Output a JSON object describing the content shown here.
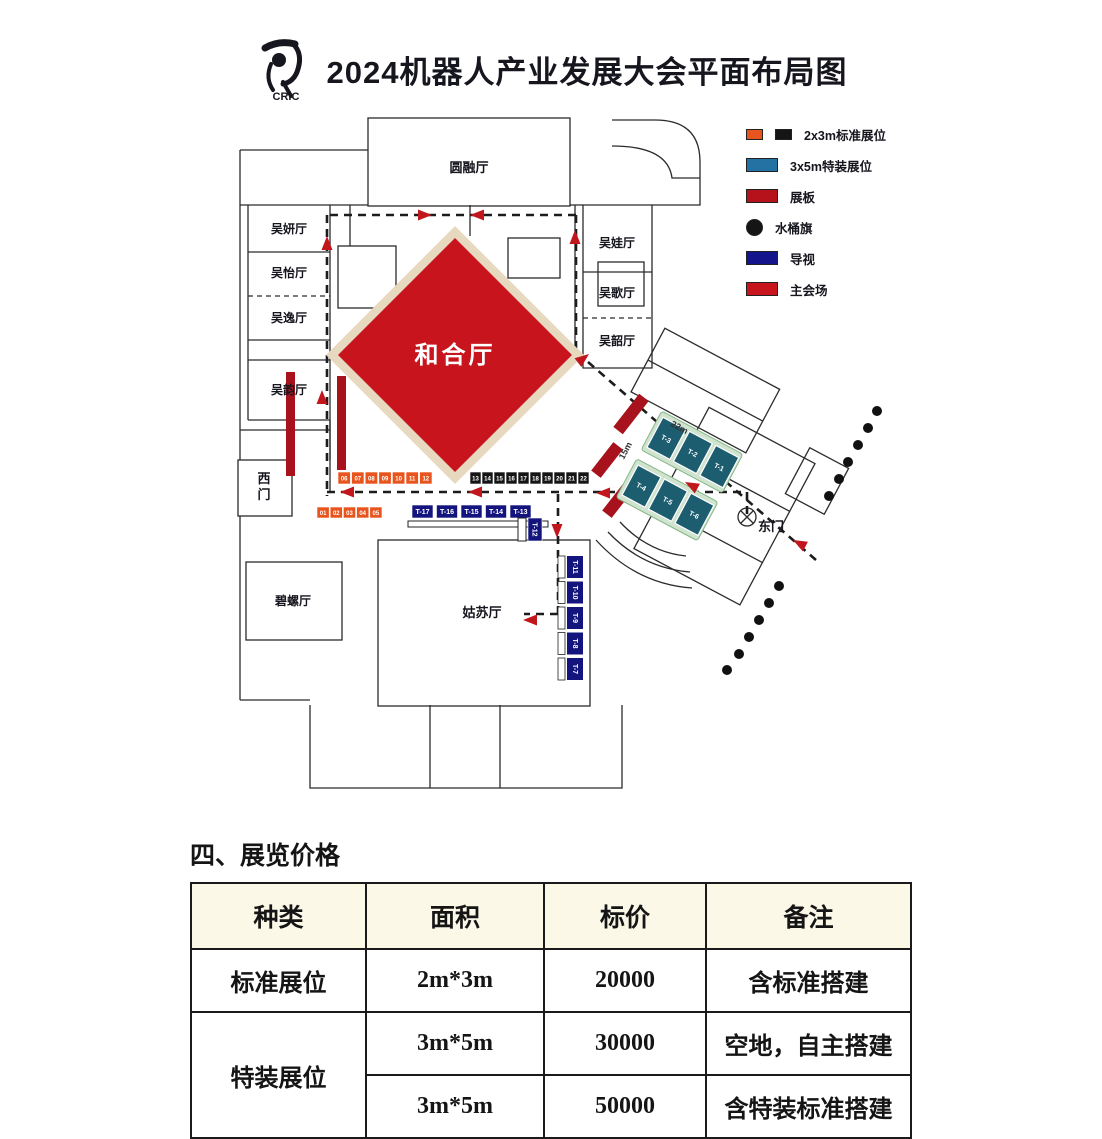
{
  "header": {
    "logo_text": "CRIC",
    "title": "2024机器人产业发展大会平面布局图"
  },
  "legend": {
    "items": [
      {
        "name": "standard-booth",
        "label": "2x3m标准展位",
        "colors": [
          "#e8541d",
          "#151515"
        ],
        "shape": "double-square"
      },
      {
        "name": "special-booth",
        "label": "3x5m特装展位",
        "colors": [
          "#2471a3"
        ],
        "shape": "rect"
      },
      {
        "name": "display-board",
        "label": "展板",
        "colors": [
          "#b5121b"
        ],
        "shape": "rect"
      },
      {
        "name": "water-flag",
        "label": "水桶旗",
        "colors": [
          "#151515"
        ],
        "shape": "circle"
      },
      {
        "name": "signage",
        "label": "导视",
        "colors": [
          "#14148c"
        ],
        "shape": "rect"
      },
      {
        "name": "main-venue",
        "label": "主会场",
        "colors": [
          "#c8141c"
        ],
        "shape": "rect"
      }
    ]
  },
  "plan": {
    "rooms": {
      "yuanrong": "圆融厅",
      "wuyan": "吴妍厅",
      "wuyi": "吴怡厅",
      "wuyi2": "吴逸厅",
      "wuyun": "吴韵厅",
      "wuwa": "吴娃厅",
      "wuge": "吴歌厅",
      "wushao": "吴韶厅",
      "hehe": "和合厅",
      "gusu": "姑苏厅",
      "biluo": "碧螺厅",
      "west_gate": "西门",
      "east_gate": "东门"
    },
    "booths": {
      "orange_row": [
        "06",
        "07",
        "08",
        "09",
        "10",
        "11",
        "12"
      ],
      "black_row": [
        "13",
        "14",
        "15",
        "16",
        "17",
        "18",
        "19",
        "20",
        "21",
        "22"
      ],
      "orange_row2": [
        "01",
        "02",
        "03",
        "04",
        "05"
      ],
      "t_row": [
        "T-17",
        "T-16",
        "T-15",
        "T-14",
        "T-13"
      ],
      "t_single": "T-12",
      "t_column": [
        "T-11",
        "T-10",
        "T-9",
        "T-8",
        "T-7"
      ],
      "cluster_north": [
        "T-3",
        "T-2",
        "T-1"
      ],
      "cluster_south": [
        "T-4",
        "T-5",
        "T-6"
      ]
    },
    "dimensions": {
      "corridor_width": "22m",
      "corridor_depth": "15m"
    },
    "colors": {
      "standard_orange": "#e8541d",
      "standard_black": "#151515",
      "special_fill": "#1d5d70",
      "special_band": "#cfe3cf",
      "special_band_edge": "#86b886",
      "board": "#a8121d",
      "signage": "#14147e",
      "main_venue": "#c8141c",
      "diamond_border": "#e7d9bf",
      "route_arrow": "#c0161c",
      "dot": "#111111"
    }
  },
  "pricing": {
    "section_title": "四、展览价格",
    "headers": [
      "种类",
      "面积",
      "标价",
      "备注"
    ],
    "rows": [
      {
        "type": "标准展位",
        "area": "2m*3m",
        "price": "20000",
        "note": "含标准搭建"
      },
      {
        "type": "特装展位",
        "area": "3m*5m",
        "price": "30000",
        "note": "空地，自主搭建"
      },
      {
        "type": "",
        "area": "3m*5m",
        "price": "50000",
        "note": "含特装标准搭建"
      }
    ]
  }
}
